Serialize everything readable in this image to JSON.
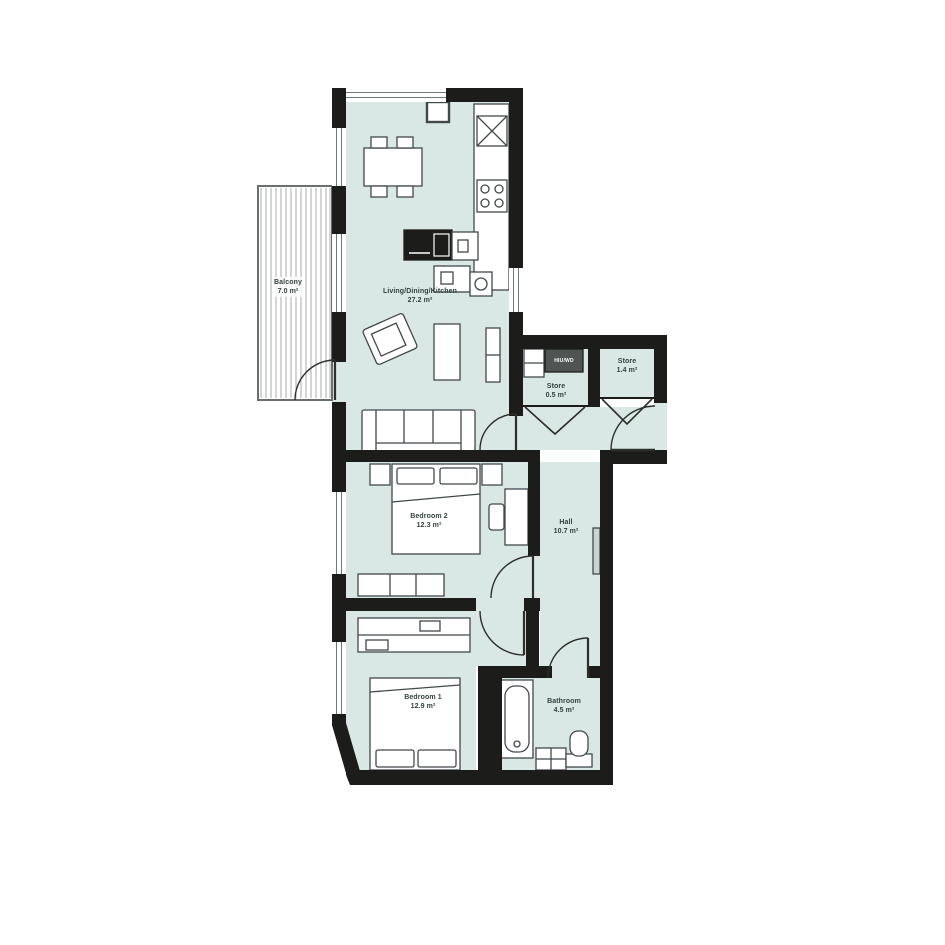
{
  "plan": {
    "title": "Apartment floor plan",
    "rooms": [
      {
        "id": "balcony",
        "name": "Balcony",
        "area": "7.0 m²"
      },
      {
        "id": "living",
        "name": "Living/Dining/Kitchen",
        "area": "27.2 m²"
      },
      {
        "id": "store_small",
        "name": "Store",
        "area": "0.5 m²"
      },
      {
        "id": "store_large",
        "name": "Store",
        "area": "1.4 m²"
      },
      {
        "id": "hall",
        "name": "Hall",
        "area": "10.7 m²"
      },
      {
        "id": "bedroom2",
        "name": "Bedroom 2",
        "area": "12.3 m²"
      },
      {
        "id": "bedroom1",
        "name": "Bedroom 1",
        "area": "12.9 m²"
      },
      {
        "id": "bathroom",
        "name": "Bathroom",
        "area": "4.5 m²"
      }
    ],
    "utility_label": "HIU/WD",
    "colors": {
      "wall": "#1c1c1a",
      "floor": "#d9e8e4",
      "furniture_line": "#41484a",
      "deck_stripe": "#a9adad",
      "utility_box": "#4f5553",
      "label_text": "#32413e"
    }
  }
}
